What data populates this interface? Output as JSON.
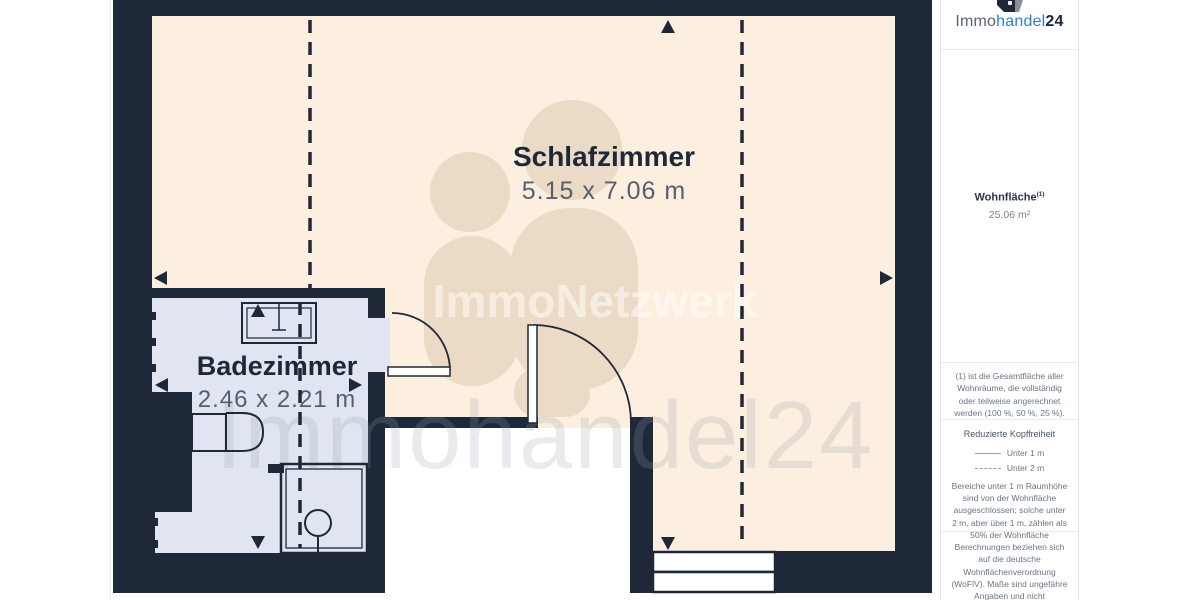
{
  "plan": {
    "rooms": [
      {
        "name": "Schlafzimmer",
        "dimensions": "5.15 x 7.06 m"
      },
      {
        "name": "Badezimmer",
        "dimensions": "2.46 x 2.21 m"
      }
    ],
    "watermarks": {
      "center": "ImmoNetzwerk",
      "bottom": "Immohandel24"
    },
    "colors": {
      "wall": "#1e2839",
      "bedroom_floor": "#fcefdf",
      "bathroom_floor": "#e0e5f1",
      "dimension_text": "#565f6f"
    }
  },
  "sidebar": {
    "logo": {
      "prefix": "Immo",
      "accent": "handel",
      "suffix": "24",
      "accent_color": "#2d7fd4"
    },
    "area": {
      "label": "Wohnfläche",
      "superscript": "(1)",
      "value": "25.06 m²"
    },
    "footnote": "(1) ist die Gesamtfläche aller Wohnräume, die vollständig oder teilweise angerechnet werden (100 %, 50 %, 25 %).",
    "headroom": {
      "title": "Reduzierte Kopffreiheit",
      "legend": [
        {
          "style": "solid",
          "label": "Unter 1 m"
        },
        {
          "style": "dashed",
          "label": "Unter 2 m"
        }
      ],
      "note": "Bereiche unter 1 m Raumhöhe sind von der Wohnfläche ausgeschlossen; solche unter 2 m, aber über 1 m, zählen als 50% der Wohnfläche"
    },
    "disclaimer": "Berechnungen beziehen sich auf die deutsche Wohnflächenverordnung (WoFlV). Maße sind ungefähre Angaben und nicht maßstabgetreu. Dieser Grundriss dient nur zur"
  }
}
